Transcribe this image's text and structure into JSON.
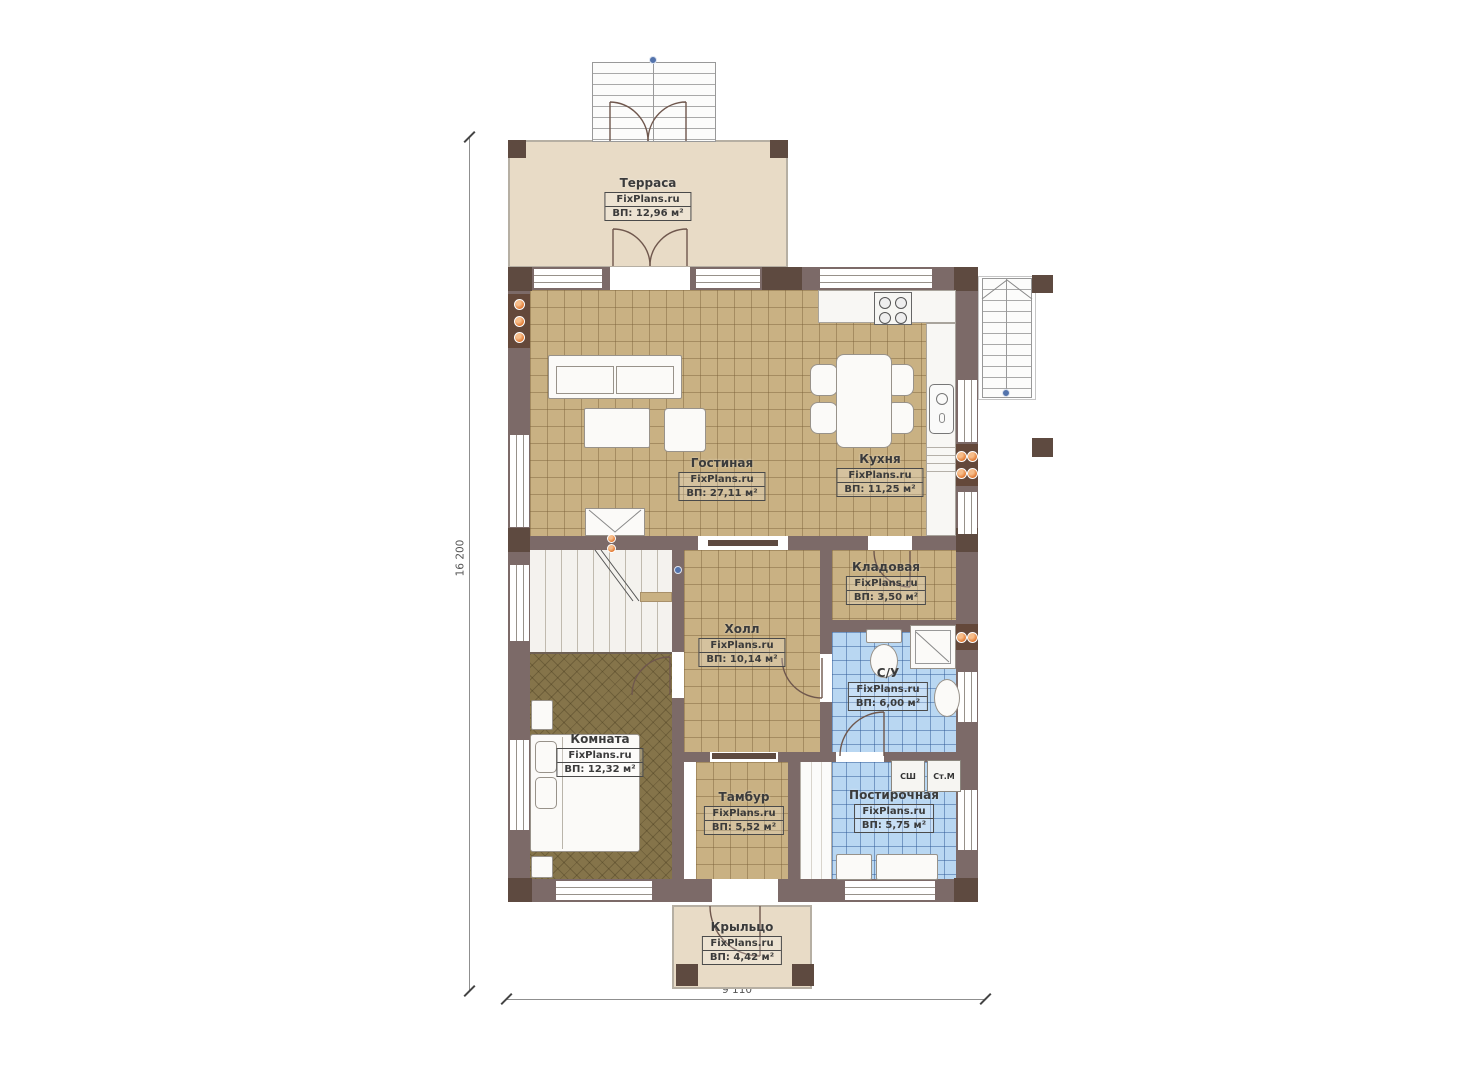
{
  "plan": {
    "watermark": "FixPlans.ru",
    "rooms": [
      {
        "name": "Терраса",
        "area": "ВП: 12,96 м²"
      },
      {
        "name": "Гостиная",
        "area": "ВП: 27,11 м²"
      },
      {
        "name": "Кухня",
        "area": "ВП: 11,25 м²"
      },
      {
        "name": "Кладовая",
        "area": "ВП: 3,50 м²"
      },
      {
        "name": "Холл",
        "area": "ВП: 10,14 м²"
      },
      {
        "name": "С/У",
        "area": "ВП: 6,00 м²"
      },
      {
        "name": "Комната",
        "area": "ВП: 12,32 м²"
      },
      {
        "name": "Тамбур",
        "area": "ВП: 5,52 м²"
      },
      {
        "name": "Постирочная",
        "area": "ВП: 5,75 м²"
      },
      {
        "name": "Крыльцо",
        "area": "ВП: 4,42 м²"
      }
    ],
    "appliances": {
      "dryer": "СШ",
      "washer": "Ст.М"
    },
    "dimensions": {
      "vertical": "16 200",
      "horizontal": "9 110"
    },
    "colors": {
      "wall": "#7c6a68",
      "wall_dark": "#5e4a40",
      "tile_tan": "#c9b183",
      "tile_blue": "#b9d7f2",
      "deck_beige": "#e8dbc6",
      "room_floor": "#85744a",
      "accent_orange": "#df732a",
      "accent_blue": "#5373ac"
    }
  }
}
